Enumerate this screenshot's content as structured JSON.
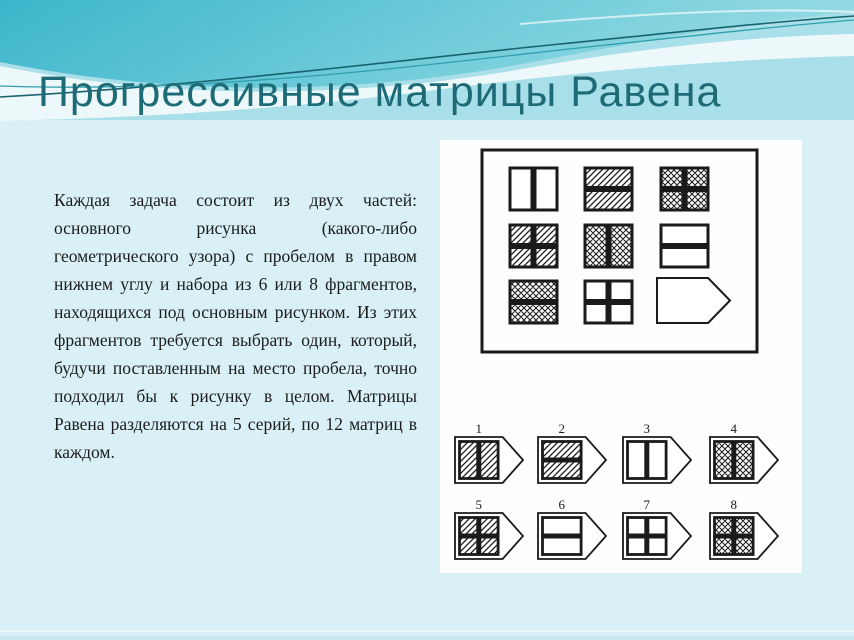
{
  "slide": {
    "title": "Прогрессивные матрицы Равена",
    "body_text": "Каждая задача состоит из двух частей: основного рисунка (какого-либо геометрического узора) с пробелом в правом нижнем углу и набора из 6 или 8 фрагментов, находящихся под основным рисунком. Из этих фрагментов требуется выбрать один, который, будучи поставленным на место пробела, точно подходил бы к рисунку в целом. Матрицы Равена разделяются на 5 серий, по 12 матриц в каждом."
  },
  "colors": {
    "title": "#1e6b78",
    "body_text": "#1c1c1c",
    "background": "#d9f0f6",
    "wave_teal_dark": "#3cb6cb",
    "wave_teal_light": "#6fcbd9",
    "wave_teal_lighter": "#97dbe5",
    "wave_mid_blue": "#a9dfe9",
    "wave_crest": "#edf8fa",
    "line_dark_teal": "#17646e",
    "line_teal": "#2f9fae",
    "figure_ink": "#1a1a1a",
    "panel_bg": "#fefefe",
    "bottom_strip": "#c9e8f0"
  },
  "figure": {
    "description": "Raven progressive matrix example: 3x3 pattern grid with missing bottom-right piece and 8 numbered answer fragments",
    "matrix": {
      "rows": 3,
      "cols": 3,
      "cells": [
        {
          "pattern": "blank",
          "bars": "vertical"
        },
        {
          "pattern": "diagonal",
          "bars": "horizontal"
        },
        {
          "pattern": "crosshatch",
          "bars": "cross"
        },
        {
          "pattern": "diagonal",
          "bars": "cross"
        },
        {
          "pattern": "crosshatch",
          "bars": "vertical"
        },
        {
          "pattern": "blank",
          "bars": "horizontal"
        },
        {
          "pattern": "crosshatch",
          "bars": "horizontal"
        },
        {
          "pattern": "blank",
          "bars": "cross"
        },
        {
          "pattern": "placeholder",
          "bars": "none"
        }
      ]
    },
    "options": [
      {
        "label": "1",
        "pattern": "diagonal",
        "bars": "vertical"
      },
      {
        "label": "2",
        "pattern": "diagonal",
        "bars": "horizontal"
      },
      {
        "label": "3",
        "pattern": "blank",
        "bars": "vertical"
      },
      {
        "label": "4",
        "pattern": "crosshatch",
        "bars": "vertical"
      },
      {
        "label": "5",
        "pattern": "diagonal",
        "bars": "cross"
      },
      {
        "label": "6",
        "pattern": "blank",
        "bars": "horizontal"
      },
      {
        "label": "7",
        "pattern": "blank",
        "bars": "cross"
      },
      {
        "label": "8",
        "pattern": "crosshatch",
        "bars": "cross"
      }
    ]
  }
}
